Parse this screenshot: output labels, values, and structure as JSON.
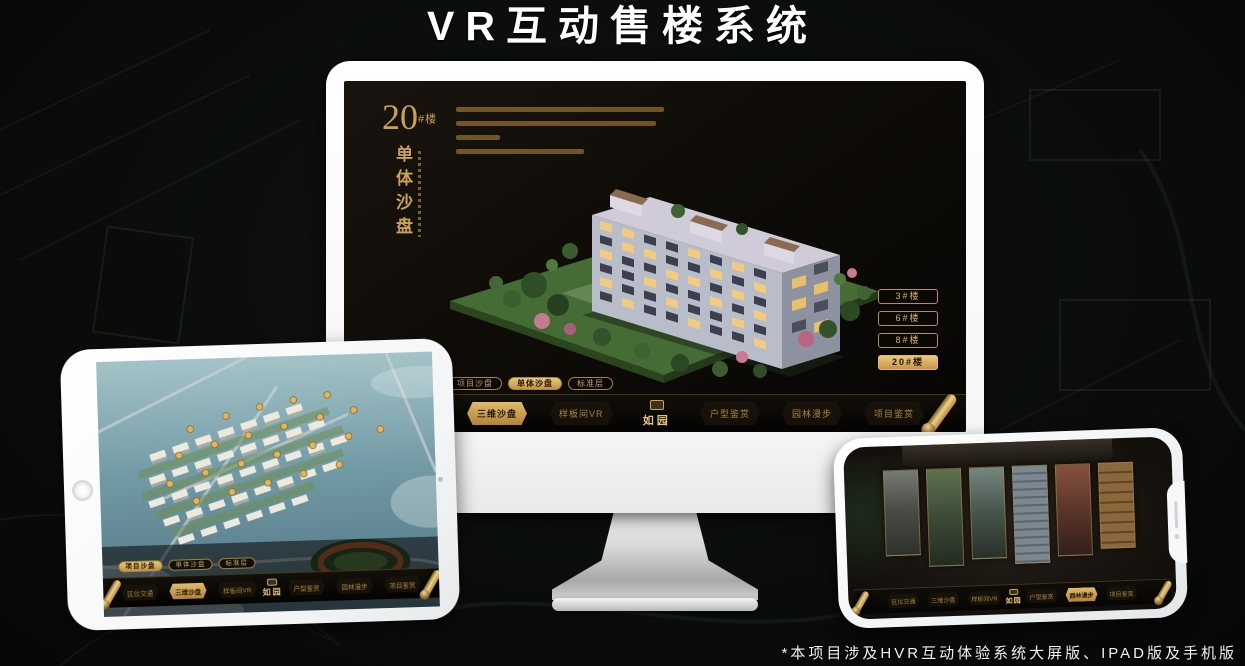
{
  "page": {
    "title": "VR互动售楼系统",
    "footnote": "*本项目涉及HVR互动体验系统大屏版、IPAD版及手机版"
  },
  "brand": {
    "logo_text": "如园"
  },
  "colors": {
    "gold_accent": "#c9a158",
    "gold_bright": "#e6c478",
    "active_button_bg": "#d9b264",
    "active_text": "#241806",
    "screen_bg": "#0f0c08",
    "title_text": "#ffffff"
  },
  "desktop": {
    "floor_number": "20",
    "floor_suffix": "#楼",
    "subtitle_vertical": "单体沙盘",
    "floor_buttons": [
      {
        "label": "3#楼",
        "active": false
      },
      {
        "label": "6#楼",
        "active": false
      },
      {
        "label": "8#楼",
        "active": false
      },
      {
        "label": "20#楼",
        "active": true
      }
    ],
    "sub_tabs": [
      {
        "label": "项目沙盘",
        "active": false
      },
      {
        "label": "单体沙盘",
        "active": true
      },
      {
        "label": "标准层",
        "active": false
      }
    ],
    "nav_items": [
      {
        "label": "区位交通",
        "active": false
      },
      {
        "label": "三维沙盘",
        "active": true
      },
      {
        "label": "样板间VR",
        "active": false
      },
      {
        "label": "户型鉴赏",
        "active": false
      },
      {
        "label": "园林漫步",
        "active": false
      },
      {
        "label": "项目鉴赏",
        "active": false
      }
    ]
  },
  "tablet": {
    "sub_tabs": [
      {
        "label": "项目沙盘",
        "active": true
      },
      {
        "label": "单体沙盘",
        "active": false
      },
      {
        "label": "标准层",
        "active": false
      }
    ],
    "nav_items": [
      {
        "label": "区位交通",
        "active": false
      },
      {
        "label": "三维沙盘",
        "active": true
      },
      {
        "label": "样板间VR",
        "active": false
      },
      {
        "label": "户型鉴赏",
        "active": false
      },
      {
        "label": "园林漫步",
        "active": false
      },
      {
        "label": "项目鉴赏",
        "active": false
      }
    ]
  },
  "phone": {
    "nav_items": [
      {
        "label": "区位交通",
        "active": false
      },
      {
        "label": "三维沙盘",
        "active": false
      },
      {
        "label": "样板间VR",
        "active": false
      },
      {
        "label": "户型鉴赏",
        "active": false
      },
      {
        "label": "园林漫步",
        "active": true
      },
      {
        "label": "项目鉴赏",
        "active": false
      }
    ]
  }
}
